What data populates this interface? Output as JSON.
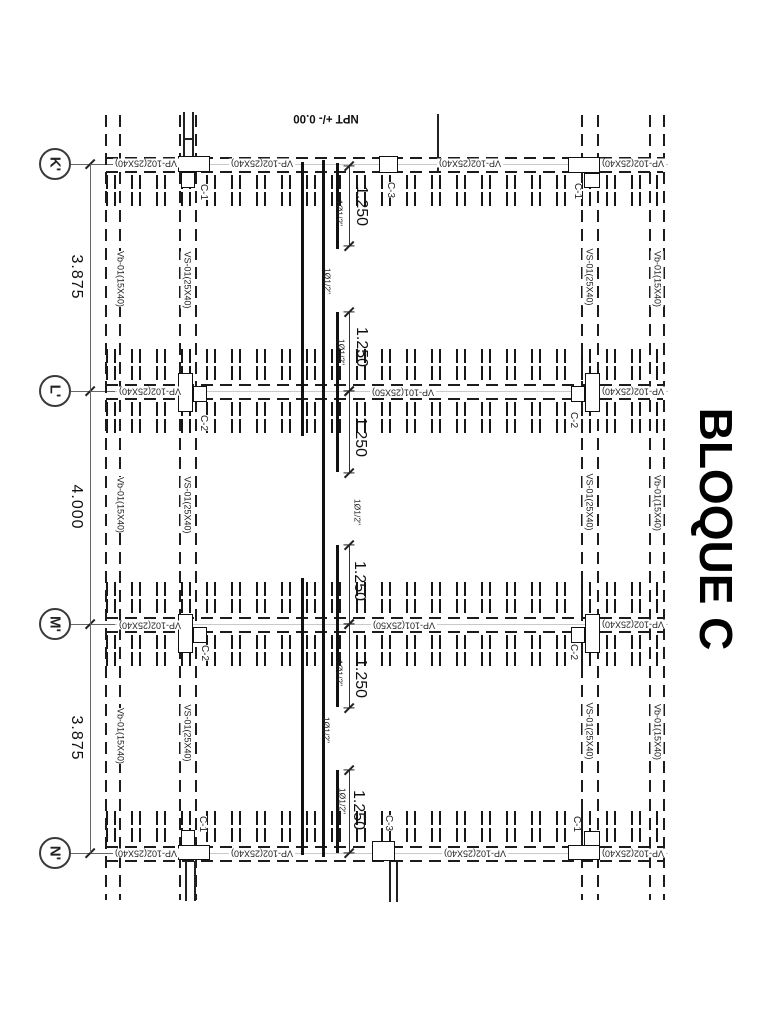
{
  "title": "BLOQUE C",
  "level_note": "NPT +/- 0.00",
  "colors": {
    "ink": "#1a1a1a",
    "background": "#ffffff"
  },
  "grid_bubbles": [
    {
      "label": "K'",
      "y": 164
    },
    {
      "label": "L'",
      "y": 391
    },
    {
      "label": "M'",
      "y": 624
    },
    {
      "label": "N'",
      "y": 853
    }
  ],
  "axis_spacings": [
    {
      "value": "3.875",
      "y": 277
    },
    {
      "value": "4.000",
      "y": 507
    },
    {
      "value": "3.875",
      "y": 738
    }
  ],
  "beam_labels_horizontal": [
    {
      "text": "VP-102(25X40)",
      "x": 146,
      "y": 163
    },
    {
      "text": "VP-102(25X40)",
      "x": 262,
      "y": 163
    },
    {
      "text": "VP-102(25X40)",
      "x": 470,
      "y": 163
    },
    {
      "text": "VP-102(25X40)",
      "x": 633,
      "y": 163
    },
    {
      "text": "VP-102(25X40)",
      "x": 150,
      "y": 391
    },
    {
      "text": "VP-101(25X50)",
      "x": 403,
      "y": 392
    },
    {
      "text": "VP-102(25X40)",
      "x": 633,
      "y": 391
    },
    {
      "text": "VP-102(25X40)",
      "x": 150,
      "y": 625
    },
    {
      "text": "VP-101(25X50)",
      "x": 404,
      "y": 625
    },
    {
      "text": "VP-102(25X40)",
      "x": 633,
      "y": 624
    },
    {
      "text": "VP-102(25X40)",
      "x": 146,
      "y": 853
    },
    {
      "text": "VP-102(25X40)",
      "x": 262,
      "y": 853
    },
    {
      "text": "VP-102(25X40)",
      "x": 475,
      "y": 853
    },
    {
      "text": "VP-102(25X40)",
      "x": 633,
      "y": 853
    }
  ],
  "beam_labels_vertical": [
    {
      "text": "Vb-01(15X40)",
      "x": 120,
      "y": 279
    },
    {
      "text": "Vb-01(15X40)",
      "x": 120,
      "y": 505
    },
    {
      "text": "Vb-01(15X40)",
      "x": 120,
      "y": 736
    },
    {
      "text": "VS-01(25X40)",
      "x": 187,
      "y": 280
    },
    {
      "text": "VS-01(25X40)",
      "x": 187,
      "y": 505
    },
    {
      "text": "VS-01(25X40)",
      "x": 187,
      "y": 733
    },
    {
      "text": "VS-01(25X40)",
      "x": 589,
      "y": 277
    },
    {
      "text": "VS-01(25X40)",
      "x": 589,
      "y": 502
    },
    {
      "text": "VS-01(25X40)",
      "x": 589,
      "y": 731
    },
    {
      "text": "Vb-01(15X40)",
      "x": 657,
      "y": 279
    },
    {
      "text": "Vb-01(15X40)",
      "x": 657,
      "y": 503
    },
    {
      "text": "Vb-01(15X40)",
      "x": 657,
      "y": 732
    }
  ],
  "column_labels": [
    {
      "text": "C-1",
      "x": 203,
      "y": 192
    },
    {
      "text": "C-1",
      "x": 577,
      "y": 191
    },
    {
      "text": "C-1",
      "x": 202,
      "y": 824
    },
    {
      "text": "C-1",
      "x": 576,
      "y": 824
    },
    {
      "text": "C-2",
      "x": 203,
      "y": 423
    },
    {
      "text": "C-2",
      "x": 573,
      "y": 420
    },
    {
      "text": "C-2",
      "x": 204,
      "y": 653
    },
    {
      "text": "C-2",
      "x": 573,
      "y": 652
    },
    {
      "text": "C-3",
      "x": 390,
      "y": 190
    },
    {
      "text": "C-3",
      "x": 388,
      "y": 823
    }
  ],
  "span_dimensions": [
    {
      "value": "1.250",
      "x": 361,
      "y": 206,
      "line": [
        166,
        246
      ]
    },
    {
      "value": "1.250",
      "x": 361,
      "y": 347,
      "line": [
        312,
        391
      ]
    },
    {
      "value": "1.250",
      "x": 360,
      "y": 437,
      "line": [
        391,
        473
      ]
    },
    {
      "value": "1.250",
      "x": 359,
      "y": 581,
      "line": [
        545,
        624
      ]
    },
    {
      "value": "1.250",
      "x": 360,
      "y": 678,
      "line": [
        624,
        708
      ]
    },
    {
      "value": "1.250",
      "x": 358,
      "y": 810,
      "line": [
        770,
        853
      ]
    }
  ],
  "rebar_callouts": [
    {
      "text": "1Ø1/2\"",
      "x": 339,
      "y": 213
    },
    {
      "text": "1Ø1/2\"",
      "x": 327,
      "y": 281
    },
    {
      "text": "1Ø1/2\"",
      "x": 341,
      "y": 352
    },
    {
      "text": "1Ø1/2\"",
      "x": 357,
      "y": 512
    },
    {
      "text": "1Ø1/2\"",
      "x": 339,
      "y": 673
    },
    {
      "text": "1Ø1/2\"",
      "x": 326,
      "y": 730
    },
    {
      "text": "1Ø1/2\"",
      "x": 342,
      "y": 801
    }
  ]
}
